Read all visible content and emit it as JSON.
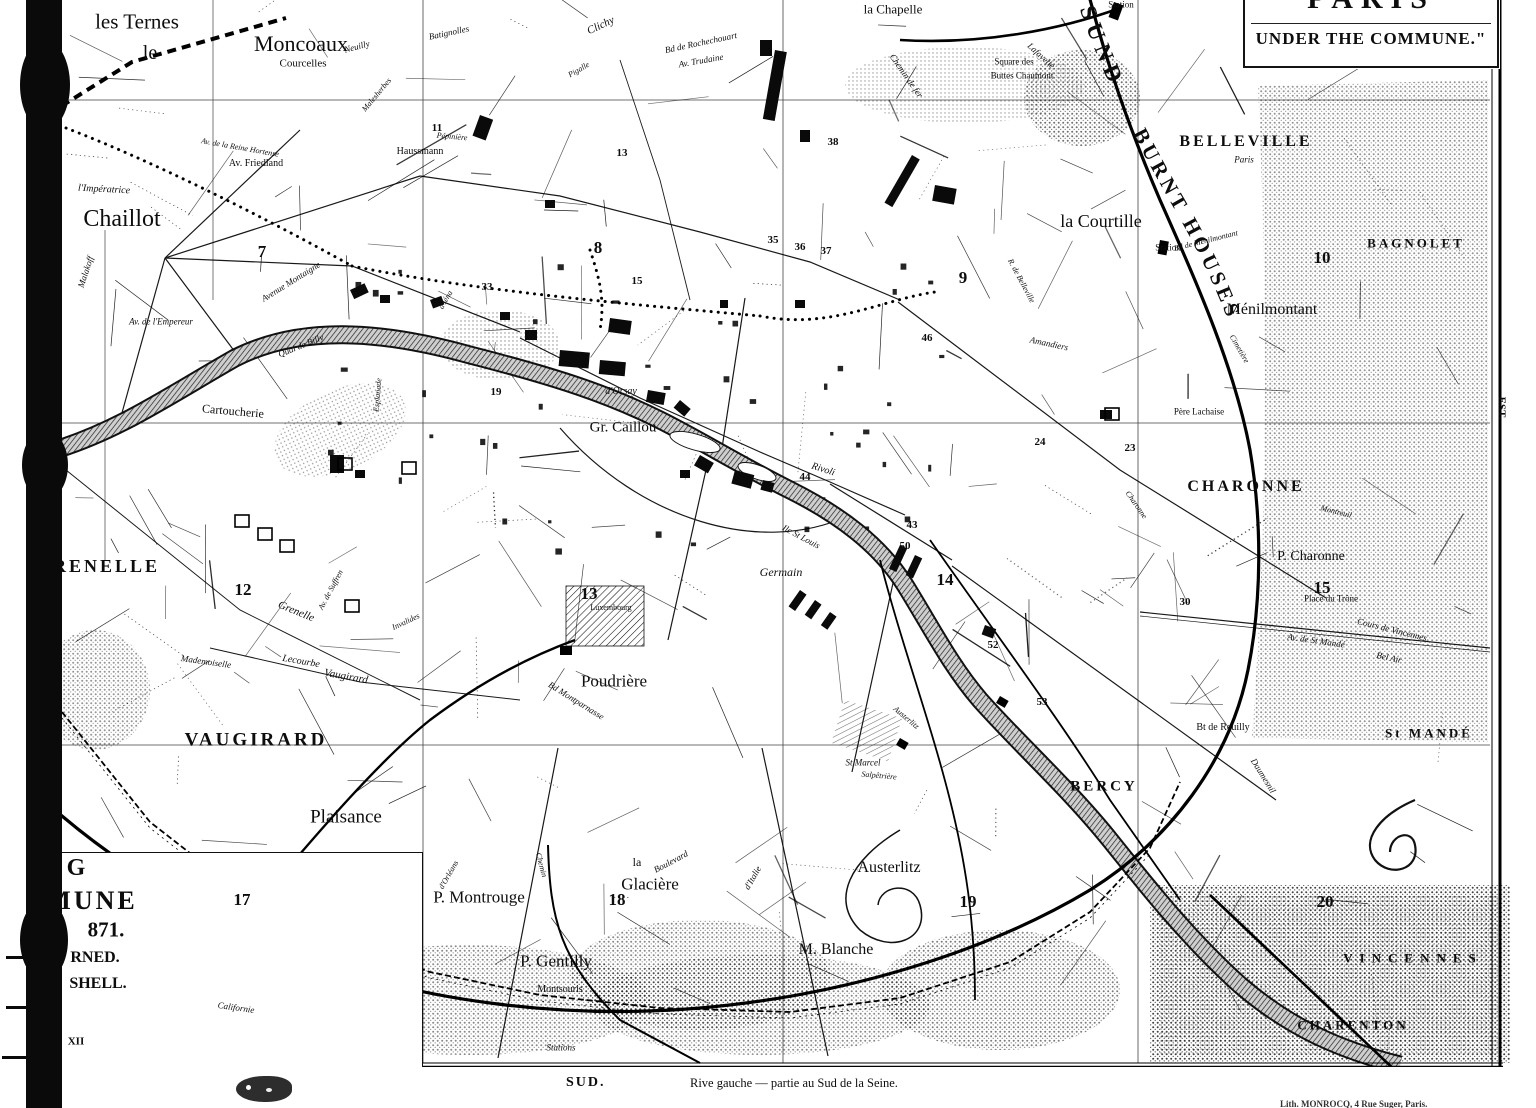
{
  "title_box": {
    "line1": "PARIS",
    "line2": "UNDER THE COMMUNE.\""
  },
  "burnt_text": {
    "part1": "SUND",
    "part2": "BURNT HOUSES"
  },
  "compass": {
    "east": "EST.",
    "south": "SUD."
  },
  "footer": {
    "direction": "SUD.",
    "caption": "Rive gauche — partie au Sud de la Seine.",
    "credit": "Lith. MONROCQ, 4 Rue Suger, Paris."
  },
  "legend": {
    "lines": [
      [
        "G",
        76,
        868,
        24
      ],
      [
        "MUNE",
        92,
        901,
        26
      ],
      [
        "871.",
        106,
        930,
        21
      ],
      [
        "RNED.",
        95,
        958,
        16
      ],
      [
        "SHELL.",
        98,
        984,
        16
      ],
      [
        "XII",
        76,
        1042,
        11
      ]
    ]
  },
  "section_numbers": [
    [
      "7",
      262,
      252
    ],
    [
      "8",
      598,
      248
    ],
    [
      "9",
      963,
      278
    ],
    [
      "10",
      1322,
      258
    ],
    [
      "12",
      243,
      590
    ],
    [
      "13",
      589,
      594
    ],
    [
      "14",
      945,
      580
    ],
    [
      "15",
      1322,
      588
    ],
    [
      "17",
      242,
      900
    ],
    [
      "18",
      617,
      900
    ],
    [
      "19",
      968,
      902
    ],
    [
      "20",
      1325,
      902
    ]
  ],
  "ref_numbers": [
    [
      "11",
      437,
      128
    ],
    [
      "38",
      833,
      142
    ],
    [
      "13",
      622,
      153
    ],
    [
      "15",
      637,
      281
    ],
    [
      "33",
      487,
      287
    ],
    [
      "35",
      773,
      240
    ],
    [
      "36",
      800,
      247
    ],
    [
      "37",
      826,
      251
    ],
    [
      "46",
      927,
      338
    ],
    [
      "19",
      496,
      392
    ],
    [
      "24",
      1040,
      442
    ],
    [
      "23",
      1130,
      448
    ],
    [
      "44",
      805,
      477
    ],
    [
      "43",
      912,
      525
    ],
    [
      "50",
      905,
      546
    ],
    [
      "30",
      1185,
      602
    ],
    [
      "52",
      993,
      645
    ],
    [
      "53",
      1042,
      702
    ]
  ],
  "map_labels": [
    [
      "les Ternes",
      137,
      22,
      21,
      0,
      ""
    ],
    [
      "Moncoaux",
      301,
      44,
      22,
      0,
      ""
    ],
    [
      "Courcelles",
      303,
      64,
      11,
      0,
      ""
    ],
    [
      "Neuilly",
      357,
      47,
      9,
      -15,
      "i"
    ],
    [
      "Batignolles",
      449,
      33,
      9,
      -12,
      "i"
    ],
    [
      "Clichy",
      601,
      26,
      11,
      -25,
      "i"
    ],
    [
      "la Chapelle",
      893,
      9,
      13,
      0,
      ""
    ],
    [
      "le",
      150,
      53,
      20,
      0,
      ""
    ],
    [
      "Chaillot",
      122,
      219,
      24,
      0,
      ""
    ],
    [
      "GRENELLE",
      98,
      566,
      18,
      0,
      "c"
    ],
    [
      "VAUGIRARD",
      256,
      740,
      19,
      0,
      "c"
    ],
    [
      "Plaisance",
      346,
      817,
      19,
      0,
      ""
    ],
    [
      "P. Montrouge",
      479,
      897,
      17,
      0,
      ""
    ],
    [
      "P. Gentilly",
      556,
      961,
      17,
      0,
      ""
    ],
    [
      "la",
      637,
      862,
      12,
      0,
      ""
    ],
    [
      "Glacière",
      650,
      884,
      17,
      0,
      ""
    ],
    [
      "Montsouris",
      560,
      990,
      10,
      0,
      ""
    ],
    [
      "Poudrière",
      614,
      681,
      17,
      0,
      ""
    ],
    [
      "BELLEVILLE",
      1246,
      142,
      16,
      0,
      "c"
    ],
    [
      "Paris",
      1244,
      160,
      9,
      0,
      "i"
    ],
    [
      "la Courtille",
      1101,
      221,
      18,
      0,
      ""
    ],
    [
      "Ménilmontant",
      1272,
      310,
      16,
      0,
      ""
    ],
    [
      "BAGNOLET",
      1416,
      243,
      13,
      0,
      "c"
    ],
    [
      "CHARONNE",
      1246,
      487,
      16,
      0,
      "c"
    ],
    [
      "P. Charonne",
      1311,
      557,
      14,
      0,
      ""
    ],
    [
      "BERCY",
      1104,
      787,
      15,
      0,
      "c"
    ],
    [
      "Austerlitz",
      889,
      868,
      16,
      0,
      ""
    ],
    [
      "M. Blanche",
      836,
      950,
      16,
      0,
      ""
    ],
    [
      "CHARENTON",
      1353,
      1025,
      13,
      0,
      "c"
    ],
    [
      "VINCENNES",
      1413,
      958,
      13,
      0,
      "C"
    ],
    [
      "St MANDÉ",
      1429,
      733,
      13,
      0,
      "c"
    ],
    [
      "Gr. Caillou",
      623,
      428,
      15,
      0,
      ""
    ],
    [
      "Cartoucherie",
      233,
      411,
      12,
      5,
      ""
    ],
    [
      "Germain",
      781,
      572,
      12,
      0,
      "i"
    ],
    [
      "Square des",
      1014,
      62,
      9,
      0,
      ""
    ],
    [
      "Buttes Chaumont",
      1022,
      76,
      9,
      0,
      ""
    ],
    [
      "Père Lachaise",
      1199,
      412,
      9,
      0,
      ""
    ],
    [
      "Av. Friedland",
      256,
      164,
      10,
      0,
      ""
    ],
    [
      "Haussmann",
      420,
      152,
      10,
      0,
      ""
    ],
    [
      "Pépinière",
      452,
      137,
      8,
      5,
      "i"
    ],
    [
      "Malesherbes",
      377,
      95,
      8,
      -50,
      "i"
    ],
    [
      "Av. de la Reine Hortense",
      240,
      148,
      8,
      10,
      "i"
    ],
    [
      "l'Impératrice",
      104,
      190,
      10,
      3,
      "i"
    ],
    [
      "Bd de Rochechouart",
      701,
      43,
      9,
      -12,
      "i"
    ],
    [
      "Av. Trudaine",
      701,
      61,
      9,
      -10,
      "i"
    ],
    [
      "Pigalle",
      579,
      70,
      8,
      -30,
      "i"
    ],
    [
      "Chemin de fer",
      906,
      76,
      9,
      55,
      "i"
    ],
    [
      "Lafayette",
      1041,
      56,
      9,
      42,
      "i"
    ],
    [
      "Station",
      1121,
      5,
      9,
      0,
      ""
    ],
    [
      "Station",
      1168,
      248,
      9,
      0,
      ""
    ],
    [
      "Bd de Ménilmontant",
      1206,
      241,
      8,
      -14,
      "i"
    ],
    [
      "Cimetière",
      1239,
      349,
      8,
      60,
      "i"
    ],
    [
      "R. de Belleville",
      1021,
      281,
      8,
      62,
      "i"
    ],
    [
      "Place du Trône",
      1331,
      599,
      9,
      0,
      ""
    ],
    [
      "Cours de Vincennes",
      1392,
      630,
      9,
      14,
      "i"
    ],
    [
      "Av. de St Mandé",
      1316,
      641,
      9,
      8,
      "i"
    ],
    [
      "Bt de Reuilly",
      1223,
      728,
      10,
      0,
      ""
    ],
    [
      "Bel Air",
      1389,
      658,
      9,
      12,
      "i"
    ],
    [
      "Daumesnil",
      1263,
      776,
      9,
      58,
      "i"
    ],
    [
      "Quai de Billy",
      301,
      346,
      9,
      -22,
      "i"
    ],
    [
      "d'Orsay",
      621,
      392,
      10,
      0,
      "i"
    ],
    [
      "Av. de l'Empereur",
      161,
      322,
      9,
      0,
      "i"
    ],
    [
      "Malakoff",
      86,
      272,
      9,
      -72,
      "i"
    ],
    [
      "Avenue Montaigne",
      291,
      282,
      9,
      -32,
      "i"
    ],
    [
      "Esplanade",
      378,
      395,
      8,
      -85,
      "i"
    ],
    [
      "d'Iéna",
      446,
      300,
      8,
      -60,
      "i"
    ],
    [
      "Grenelle",
      296,
      612,
      11,
      22,
      "i"
    ],
    [
      "Lecourbe",
      301,
      662,
      10,
      10,
      "i"
    ],
    [
      "Mademoiselle",
      206,
      662,
      9,
      8,
      "i"
    ],
    [
      "Vaugirard",
      346,
      677,
      11,
      10,
      "i"
    ],
    [
      "Av. de Suffren",
      331,
      590,
      8,
      -62,
      "i"
    ],
    [
      "Invalides",
      406,
      622,
      8,
      -25,
      "i"
    ],
    [
      "Bd Montparnasse",
      576,
      701,
      9,
      32,
      "i"
    ],
    [
      "Luxembourg",
      611,
      608,
      8,
      0,
      ""
    ],
    [
      "Ile St Louis",
      801,
      537,
      9,
      28,
      "i"
    ],
    [
      "Rivoli",
      823,
      470,
      10,
      18,
      "i"
    ],
    [
      "St Marcel",
      863,
      763,
      9,
      0,
      "i"
    ],
    [
      "Salpêtrière",
      879,
      776,
      8,
      5,
      "i"
    ],
    [
      "Boulevard",
      671,
      862,
      9,
      -28,
      "i"
    ],
    [
      "d'Italie",
      753,
      878,
      9,
      -60,
      "i"
    ],
    [
      "Austerlitz",
      906,
      718,
      8,
      40,
      "i"
    ],
    [
      "Stations",
      561,
      1048,
      9,
      0,
      "i"
    ],
    [
      "Californie",
      236,
      1008,
      9,
      8,
      "i"
    ],
    [
      "Chemin",
      541,
      865,
      8,
      75,
      "i"
    ],
    [
      "d'Orléans",
      449,
      875,
      8,
      -60,
      "i"
    ],
    [
      "Amandiers",
      1049,
      344,
      9,
      12,
      "i"
    ],
    [
      "Charonne",
      1136,
      505,
      8,
      55,
      "i"
    ],
    [
      "Montreuil",
      1336,
      512,
      8,
      14,
      "i"
    ],
    [
      "EST.",
      1501,
      408,
      11,
      90,
      "b"
    ]
  ],
  "map_marks": {
    "burnt_blocks": [
      [
        480,
        115,
        14,
        22,
        20
      ],
      [
        545,
        200,
        10,
        8,
        0
      ],
      [
        610,
        318,
        22,
        14,
        8
      ],
      [
        560,
        350,
        30,
        16,
        5
      ],
      [
        600,
        360,
        26,
        14,
        5
      ],
      [
        648,
        390,
        18,
        12,
        10
      ],
      [
        680,
        400,
        14,
        10,
        40
      ],
      [
        700,
        455,
        16,
        12,
        30
      ],
      [
        735,
        470,
        20,
        14,
        15
      ],
      [
        763,
        480,
        12,
        10,
        15
      ],
      [
        525,
        330,
        12,
        10,
        0
      ],
      [
        500,
        312,
        10,
        8,
        0
      ],
      [
        430,
        300,
        12,
        9,
        -20
      ],
      [
        380,
        295,
        10,
        8,
        0
      ],
      [
        350,
        290,
        16,
        10,
        -25
      ],
      [
        330,
        455,
        14,
        18,
        0
      ],
      [
        355,
        470,
        10,
        8,
        0
      ],
      [
        800,
        590,
        8,
        20,
        35
      ],
      [
        815,
        600,
        8,
        18,
        35
      ],
      [
        830,
        612,
        8,
        16,
        35
      ],
      [
        900,
        545,
        8,
        26,
        25
      ],
      [
        915,
        555,
        8,
        22,
        25
      ],
      [
        795,
        300,
        10,
        8,
        0
      ],
      [
        935,
        185,
        22,
        16,
        10
      ],
      [
        1100,
        410,
        12,
        9,
        0
      ],
      [
        985,
        625,
        12,
        10,
        20
      ],
      [
        760,
        40,
        12,
        16,
        0
      ],
      [
        800,
        130,
        10,
        12,
        0
      ],
      [
        680,
        470,
        10,
        8,
        0
      ],
      [
        720,
        300,
        8,
        8,
        0
      ],
      [
        775,
        50,
        12,
        70,
        10
      ],
      [
        912,
        155,
        9,
        55,
        30
      ]
    ],
    "outline_squares": [
      [
        235,
        515
      ],
      [
        258,
        528
      ],
      [
        280,
        540
      ],
      [
        338,
        458
      ],
      [
        402,
        462
      ],
      [
        345,
        600
      ],
      [
        1105,
        408
      ]
    ],
    "stations": [
      [
        1114,
        2,
        10,
        16,
        20
      ],
      [
        1160,
        240,
        9,
        14,
        10
      ],
      [
        560,
        646,
        12,
        9,
        0
      ],
      [
        900,
        738,
        10,
        8,
        30
      ],
      [
        1000,
        696,
        10,
        8,
        30
      ]
    ]
  },
  "colors": {
    "ink": "#0d0d0d",
    "paper": "#ffffff"
  }
}
